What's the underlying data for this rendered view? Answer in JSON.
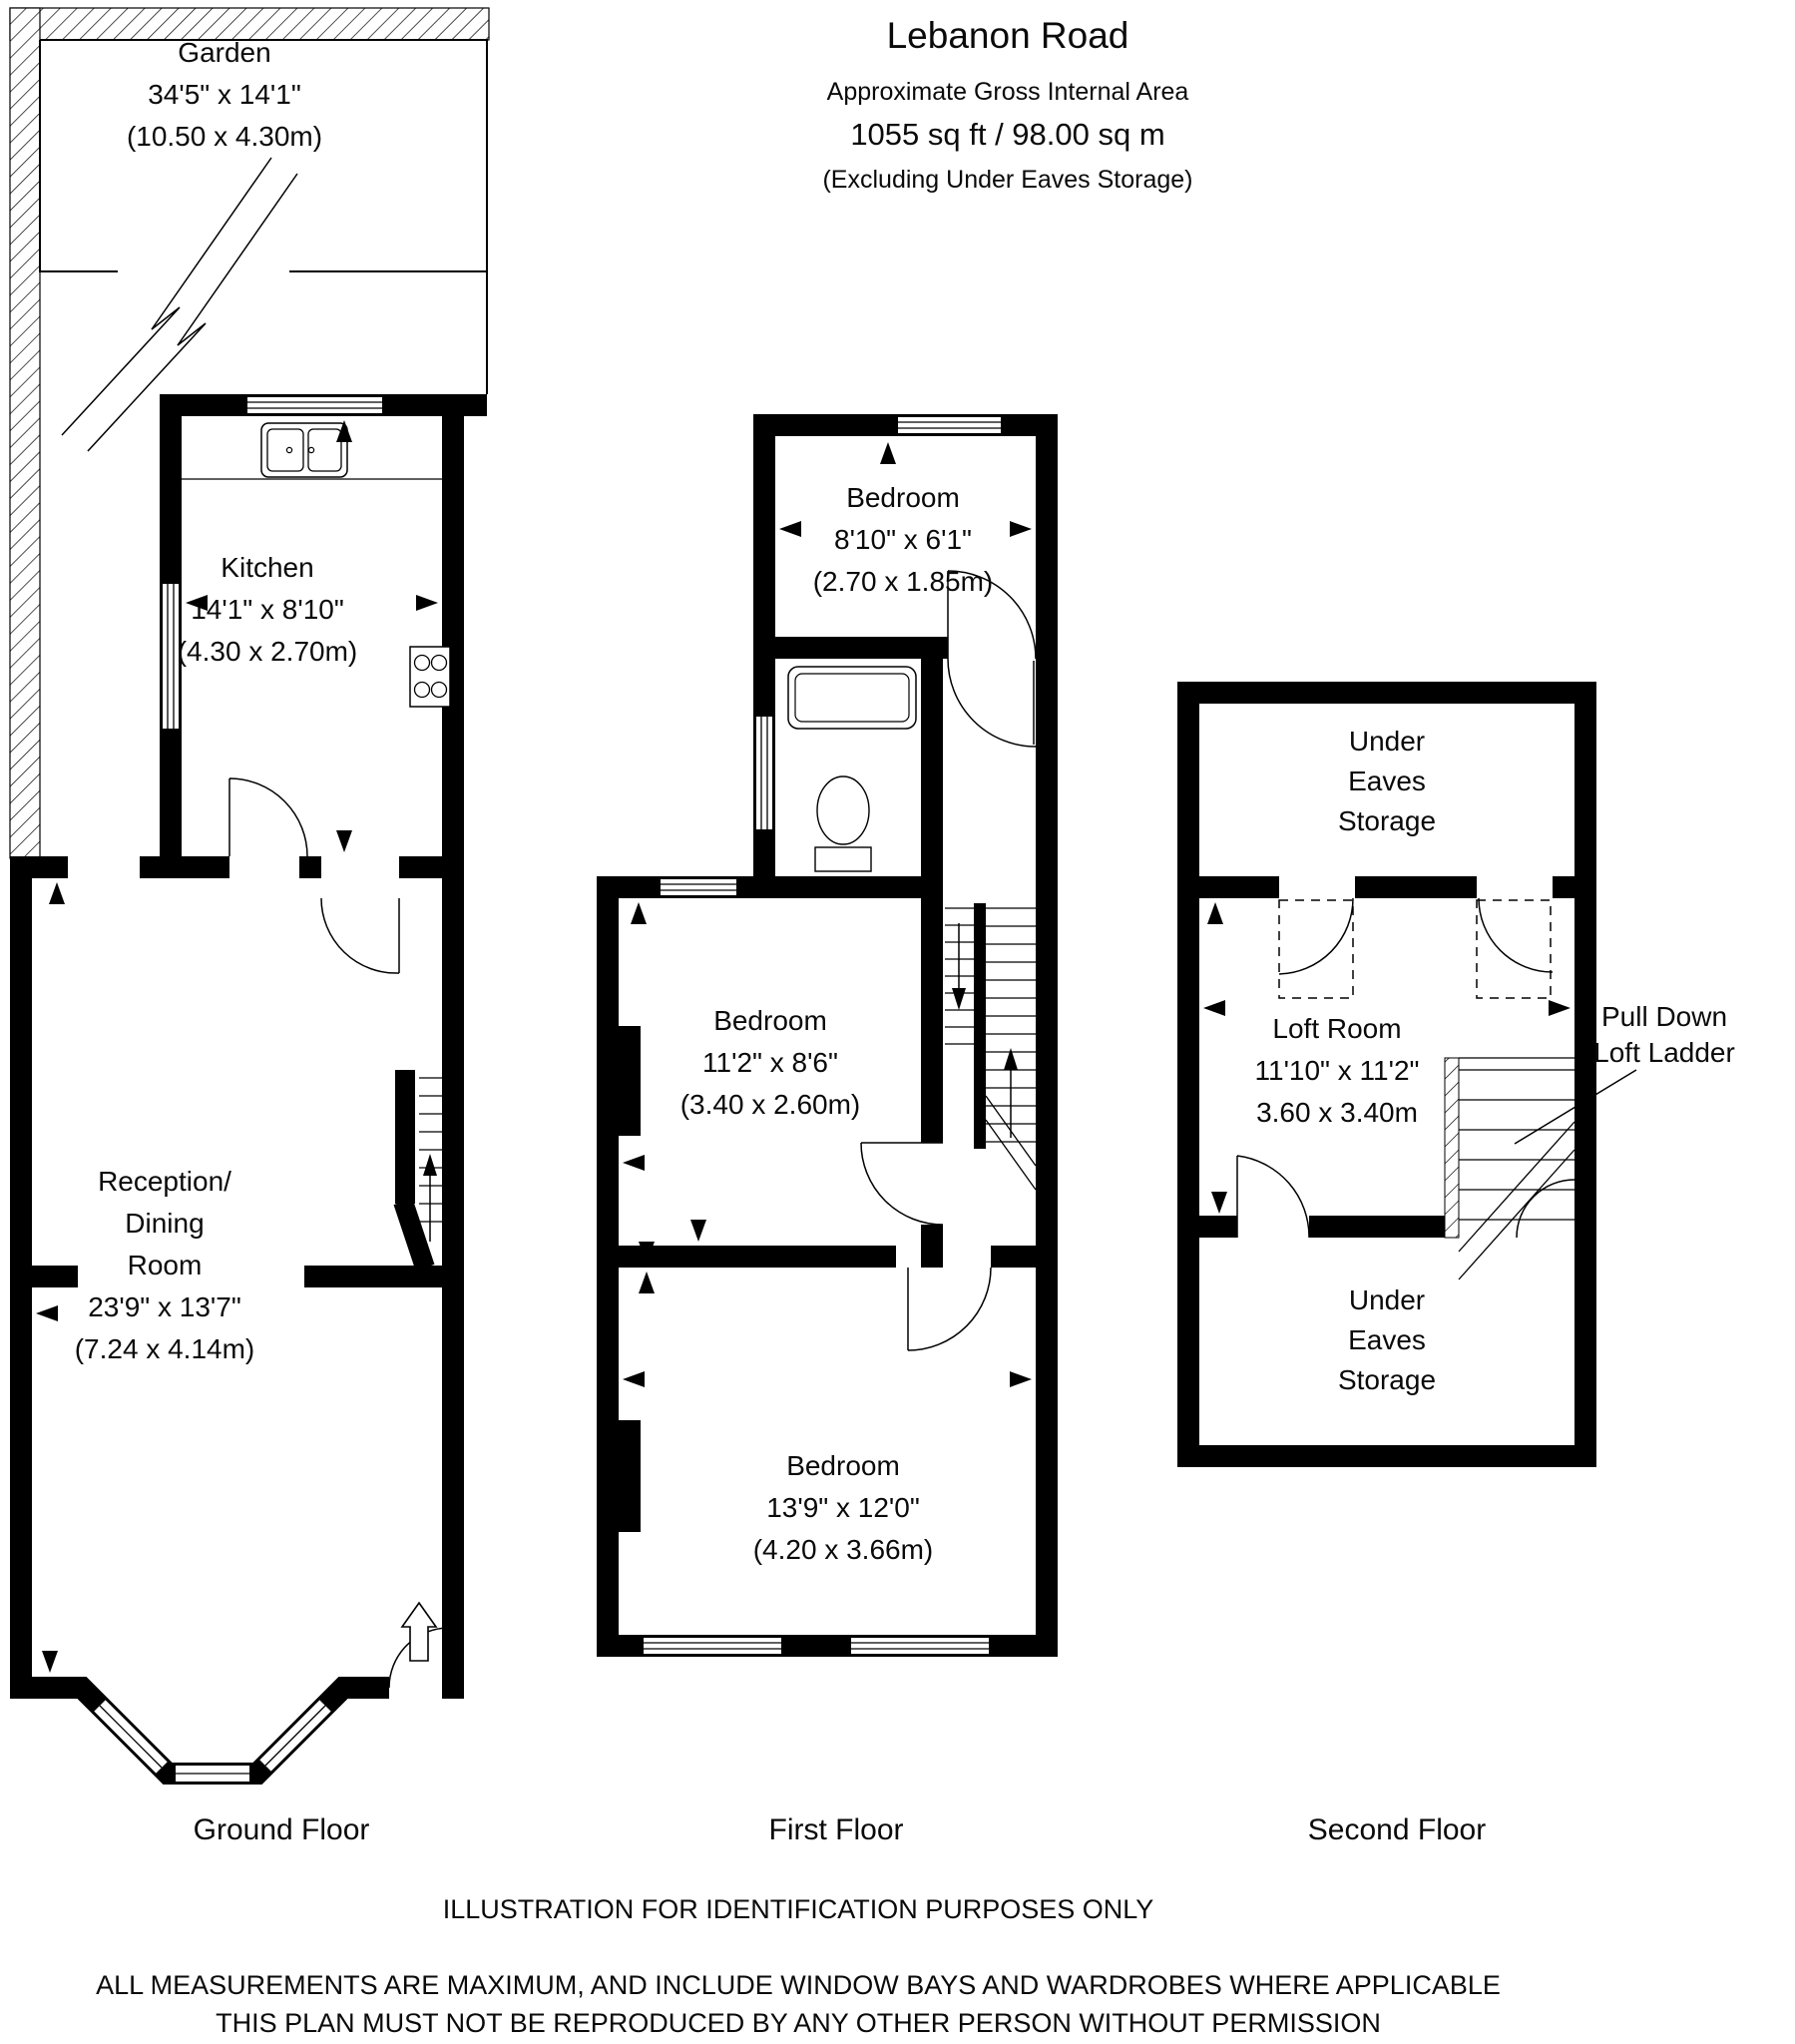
{
  "header": {
    "title": "Lebanon Road",
    "subtitle": "Approximate Gross Internal Area",
    "area": "1055 sq ft / 98.00 sq m",
    "note": "(Excluding Under Eaves Storage)"
  },
  "ground_floor": {
    "label": "Ground Floor",
    "rooms": {
      "garden": {
        "name": "Garden",
        "imperial": "34'5\" x 14'1\"",
        "metric": "(10.50 x 4.30m)"
      },
      "kitchen": {
        "name": "Kitchen",
        "imperial": "14'1\" x 8'10\"",
        "metric": "(4.30 x 2.70m)"
      },
      "reception": {
        "lines": [
          "Reception/",
          "Dining",
          "Room"
        ],
        "imperial": "23'9\" x 13'7\"",
        "metric": "(7.24 x 4.14m)"
      }
    }
  },
  "first_floor": {
    "label": "First Floor",
    "rooms": {
      "bedroom_top": {
        "name": "Bedroom",
        "imperial": "8'10\" x 6'1\"",
        "metric": "(2.70 x 1.85m)"
      },
      "bedroom_middle": {
        "name": "Bedroom",
        "imperial": "11'2\" x 8'6\"",
        "metric": "(3.40 x 2.60m)"
      },
      "bedroom_bottom": {
        "name": "Bedroom",
        "imperial": "13'9\" x 12'0\"",
        "metric": "(4.20 x 3.66m)"
      }
    }
  },
  "second_floor": {
    "label": "Second Floor",
    "rooms": {
      "storage_top": {
        "lines": [
          "Under",
          "Eaves",
          "Storage"
        ]
      },
      "loft": {
        "name": "Loft Room",
        "imperial": "11'10\" x 11'2\"",
        "metric": "3.60 x 3.40m"
      },
      "storage_bottom": {
        "lines": [
          "Under",
          "Eaves",
          "Storage"
        ]
      },
      "ladder_label": {
        "lines": [
          "Pull Down",
          "Loft Ladder"
        ]
      }
    }
  },
  "footer": {
    "disclaimer": "ILLUSTRATION FOR IDENTIFICATION PURPOSES ONLY",
    "measurements": "ALL MEASUREMENTS ARE MAXIMUM, AND INCLUDE WINDOW BAYS AND WARDROBES WHERE APPLICABLE",
    "copyright": "THIS PLAN MUST NOT BE REPRODUCED BY ANY OTHER PERSON WITHOUT PERMISSION"
  },
  "colors": {
    "wall": "#000000",
    "background": "#ffffff"
  }
}
